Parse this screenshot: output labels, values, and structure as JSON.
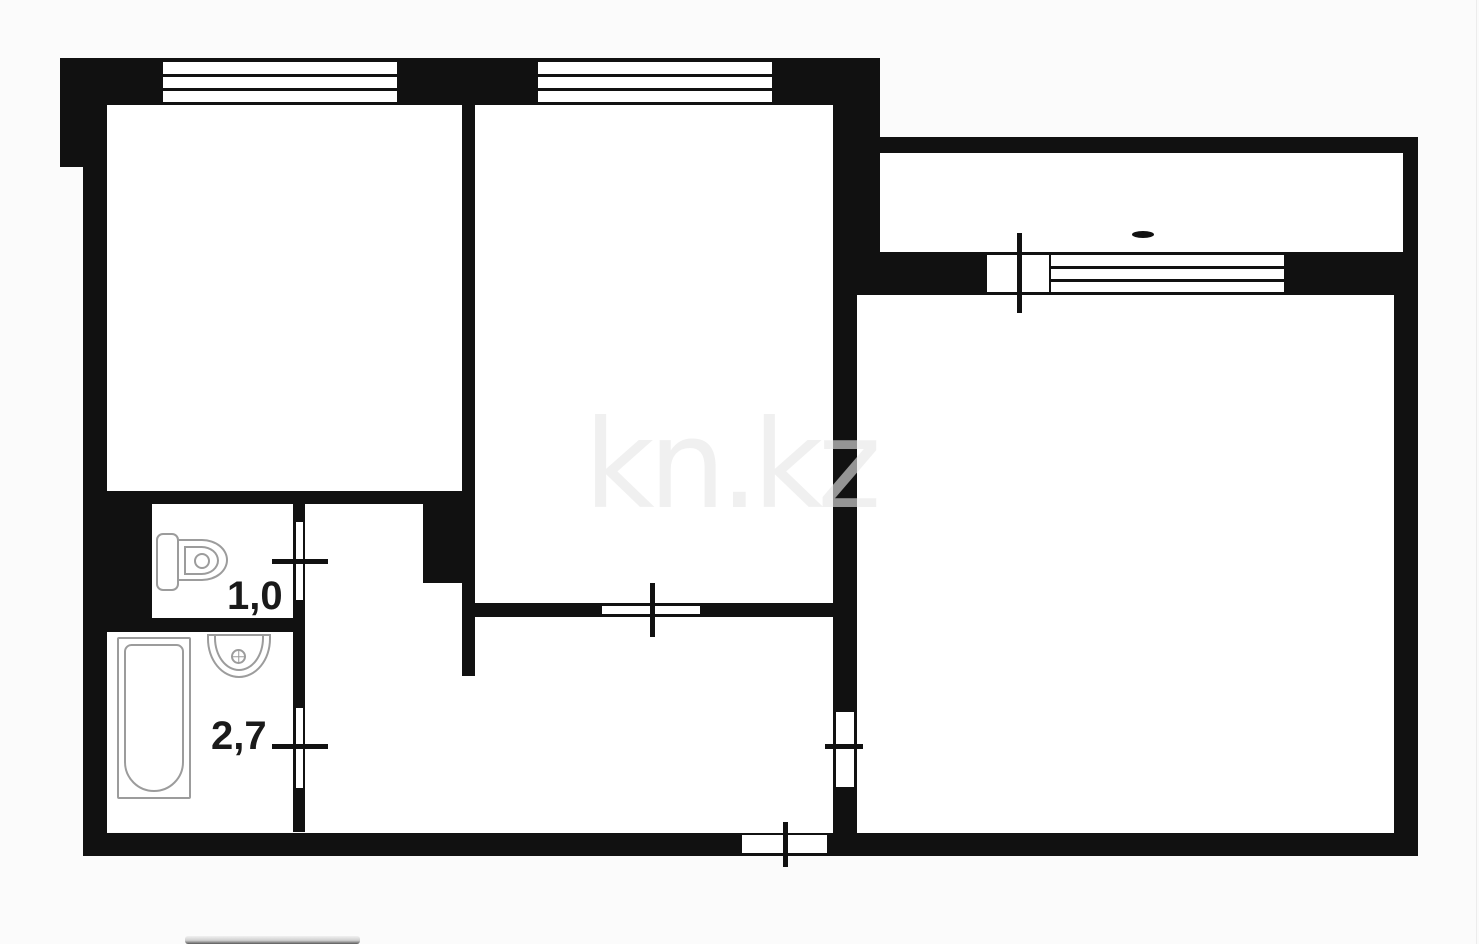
{
  "watermark": {
    "text": "kn.kz"
  },
  "labels": [
    {
      "name": "area-label-toilet",
      "text": "1,0"
    },
    {
      "name": "area-label-bath",
      "text": "2,7"
    }
  ],
  "colors": {
    "wall": "#111111",
    "room_fill": "#ffffff",
    "background": "#fbfbfb",
    "fixture_outline": "#9c9c9c",
    "label_text": "#1a1a1a"
  },
  "plan": {
    "rooms": [
      {
        "name": "room-top-left",
        "x": 107,
        "y": 105,
        "w": 356,
        "h": 386
      },
      {
        "name": "room-top-middle",
        "x": 475,
        "y": 105,
        "w": 358,
        "h": 498
      },
      {
        "name": "room-toilet",
        "x": 152,
        "y": 503,
        "w": 141,
        "h": 115
      },
      {
        "name": "room-bathroom",
        "x": 107,
        "y": 632,
        "w": 186,
        "h": 200
      },
      {
        "name": "corridor-upper",
        "x": 305,
        "y": 503,
        "w": 118,
        "h": 80
      },
      {
        "name": "corridor-mid",
        "x": 305,
        "y": 583,
        "w": 157,
        "h": 250
      },
      {
        "name": "corridor-gap",
        "x": 462,
        "y": 676,
        "w": 13,
        "h": 157
      },
      {
        "name": "hallway",
        "x": 475,
        "y": 617,
        "w": 358,
        "h": 216
      },
      {
        "name": "room-right",
        "x": 857,
        "y": 295,
        "w": 537,
        "h": 538
      },
      {
        "name": "balcony",
        "x": 880,
        "y": 153,
        "w": 523,
        "h": 99
      }
    ],
    "walls": [
      {
        "name": "wall-top",
        "x": 60,
        "y": 58,
        "w": 820,
        "h": 47
      },
      {
        "name": "wall-left-corner-block",
        "x": 60,
        "y": 58,
        "w": 47,
        "h": 109
      },
      {
        "name": "wall-left",
        "x": 83,
        "y": 167,
        "w": 24,
        "h": 689
      },
      {
        "name": "wall-bottom",
        "x": 83,
        "y": 833,
        "w": 1335,
        "h": 23
      },
      {
        "name": "wall-right",
        "x": 1394,
        "y": 293,
        "w": 24,
        "h": 563
      },
      {
        "name": "wall-balcony-right",
        "x": 1403,
        "y": 137,
        "w": 15,
        "h": 158
      },
      {
        "name": "wall-balcony-top",
        "x": 877,
        "y": 137,
        "w": 541,
        "h": 16
      },
      {
        "name": "wall-balcony-left-block",
        "x": 833,
        "y": 103,
        "w": 47,
        "h": 149
      },
      {
        "name": "wall-balcony-band",
        "x": 833,
        "y": 252,
        "w": 585,
        "h": 43
      },
      {
        "name": "wall-rightroom-left",
        "x": 833,
        "y": 295,
        "w": 24,
        "h": 538
      },
      {
        "name": "wall-rooms-divider",
        "x": 462,
        "y": 105,
        "w": 13,
        "h": 387
      },
      {
        "name": "wall-room1-bottom",
        "x": 83,
        "y": 491,
        "w": 392,
        "h": 13
      },
      {
        "name": "wall-center-block",
        "x": 423,
        "y": 504,
        "w": 52,
        "h": 79
      },
      {
        "name": "wall-divider-lower",
        "x": 462,
        "y": 583,
        "w": 13,
        "h": 93
      },
      {
        "name": "wall-room2-bottom",
        "x": 475,
        "y": 603,
        "w": 358,
        "h": 14
      },
      {
        "name": "wall-toilet-left-block",
        "x": 107,
        "y": 503,
        "w": 45,
        "h": 115
      },
      {
        "name": "wall-toilet-bath-divider",
        "x": 107,
        "y": 618,
        "w": 186,
        "h": 14
      },
      {
        "name": "wall-wet-doors",
        "x": 293,
        "y": 503,
        "w": 12,
        "h": 329
      }
    ],
    "slots": [
      {
        "name": "window-room1",
        "x": 163,
        "y": 62,
        "w": 234,
        "h": 40,
        "mullions": 2
      },
      {
        "name": "window-room2",
        "x": 538,
        "y": 62,
        "w": 234,
        "h": 40,
        "mullions": 2
      },
      {
        "name": "window-balcony",
        "x": 1051,
        "y": 255,
        "w": 233,
        "h": 37,
        "mullions": 2
      },
      {
        "name": "door-balcony",
        "x": 987,
        "y": 255,
        "w": 62,
        "h": 37
      },
      {
        "name": "door-toilet",
        "x": 296,
        "y": 522,
        "w": 7,
        "h": 78
      },
      {
        "name": "door-bathroom",
        "x": 296,
        "y": 708,
        "w": 7,
        "h": 80
      },
      {
        "name": "door-room2",
        "x": 602,
        "y": 606,
        "w": 98,
        "h": 8
      },
      {
        "name": "door-right-room",
        "x": 836,
        "y": 712,
        "w": 18,
        "h": 75
      },
      {
        "name": "door-entrance",
        "x": 742,
        "y": 835,
        "w": 85,
        "h": 18
      }
    ],
    "ticks": [
      {
        "name": "tick-door-toilet",
        "x": 272,
        "y": 559,
        "w": 56,
        "h": 5
      },
      {
        "name": "tick-door-bathroom",
        "x": 272,
        "y": 744,
        "w": 56,
        "h": 5
      },
      {
        "name": "tick-door-room2",
        "x": 650,
        "y": 583,
        "w": 5,
        "h": 54
      },
      {
        "name": "tick-door-right-room",
        "x": 825,
        "y": 744,
        "w": 38,
        "h": 5
      },
      {
        "name": "tick-door-balcony",
        "x": 1017,
        "y": 233,
        "w": 5,
        "h": 80
      },
      {
        "name": "tick-door-entrance",
        "x": 783,
        "y": 822,
        "w": 5,
        "h": 45
      }
    ],
    "marks": [
      {
        "name": "balcony-dash-mark",
        "x": 1132,
        "y": 231,
        "w": 22,
        "h": 7
      }
    ],
    "fixtures": [
      {
        "name": "toilet-tank",
        "kind": "tank",
        "x": 156,
        "y": 533,
        "w": 23,
        "h": 58
      },
      {
        "name": "toilet-bowl-outer",
        "kind": "bowl-outer",
        "x": 177,
        "y": 539,
        "w": 51,
        "h": 42
      },
      {
        "name": "toilet-bowl-inner",
        "kind": "bowl-inner",
        "x": 184,
        "y": 546,
        "w": 35,
        "h": 29
      },
      {
        "name": "toilet-flush-hole",
        "kind": "circle",
        "x": 194,
        "y": 553,
        "w": 16,
        "h": 16
      },
      {
        "name": "sink-basin-outer",
        "kind": "sink-outer",
        "x": 207,
        "y": 634,
        "w": 64,
        "h": 44
      },
      {
        "name": "sink-basin-inner",
        "kind": "sink-inner",
        "x": 214,
        "y": 634,
        "w": 50,
        "h": 37
      },
      {
        "name": "sink-faucet",
        "kind": "circle-cross",
        "x": 231,
        "y": 649,
        "w": 15,
        "h": 15
      },
      {
        "name": "bathtub-outer",
        "kind": "tub-outer",
        "x": 117,
        "y": 637,
        "w": 74,
        "h": 162
      },
      {
        "name": "bathtub-inner",
        "kind": "tub-inner",
        "x": 124,
        "y": 644,
        "w": 60,
        "h": 148
      }
    ]
  }
}
